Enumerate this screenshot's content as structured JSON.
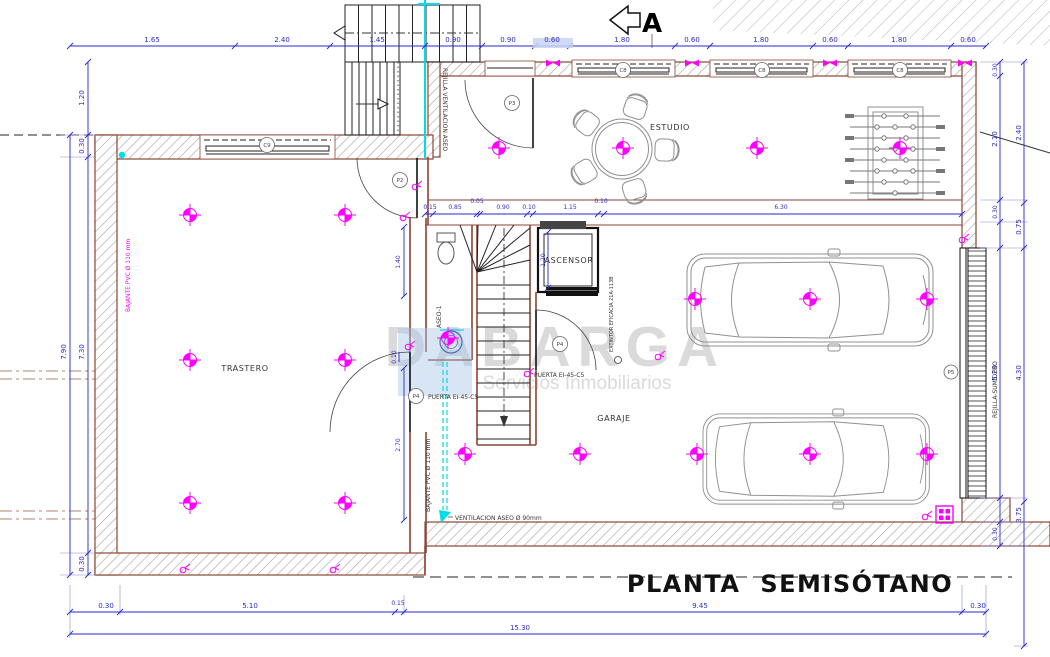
{
  "plan": {
    "title": "PLANTA SEMISÓTANO",
    "watermark": {
      "brand": "DABARGA",
      "subtitle": "Servicios Inmobiliarios"
    },
    "rooms": {
      "estudio": "ESTUDIO",
      "trastero": "TRASTERO",
      "garaje": "GARAJE",
      "ascensor": "ASCENSOR",
      "aseo": "ASEO-1"
    },
    "annotations": {
      "section_marker": "A",
      "rejilla_ventilacion": "REJILLA VENTILACION ASEO",
      "bajante_pvc": "BAJANTE PVC Ø 110 mm",
      "ventilacion_aseo": "VENTILACION ASEO Ø 90mm",
      "puerta_ei": "PUERTA EI-45-C5",
      "extintor": "EXTINTOR EFICACIA 21A-113B",
      "rejilla_sumidero": "REJILLA-SUMIDERO"
    },
    "tags": {
      "c8": "C8",
      "c9": "C9",
      "p2": "P2",
      "p3": "P3",
      "p4": "P4",
      "p5": "P5"
    },
    "dims": {
      "top": [
        "1.65",
        "2.40",
        "1.45",
        "0.90",
        "0.90",
        "0.60",
        "1.80",
        "0.60",
        "1.80",
        "0.60",
        "1.80",
        "0.60"
      ],
      "interior": [
        "0.15",
        "0.85",
        "0.05",
        "0.90",
        "0.10",
        "1.15",
        "0.10",
        "6.30"
      ],
      "left": [
        "1.20",
        "0.30",
        "7.30",
        "0.30"
      ],
      "left_total": "7.90",
      "right_inner": [
        "0.30",
        "2.10",
        "0.30",
        "5.20",
        "0.30"
      ],
      "right_outer": [
        "2.40",
        "0.75",
        "4.30",
        "3.75"
      ],
      "bottom": [
        "0.30",
        "5.10",
        "0.15",
        "9.45",
        "0.30"
      ],
      "bottom_total": "15.30",
      "elevator": "1.20",
      "aseo": "1.40",
      "garage_west": "2.70",
      "door_offset": "0.10"
    },
    "colors": {
      "dimension": "#2a2acc",
      "wall": "#8a4636",
      "accent_magenta": "#ff00ff",
      "accent_cyan": "#00dde6",
      "watermark": "#dadada"
    }
  }
}
